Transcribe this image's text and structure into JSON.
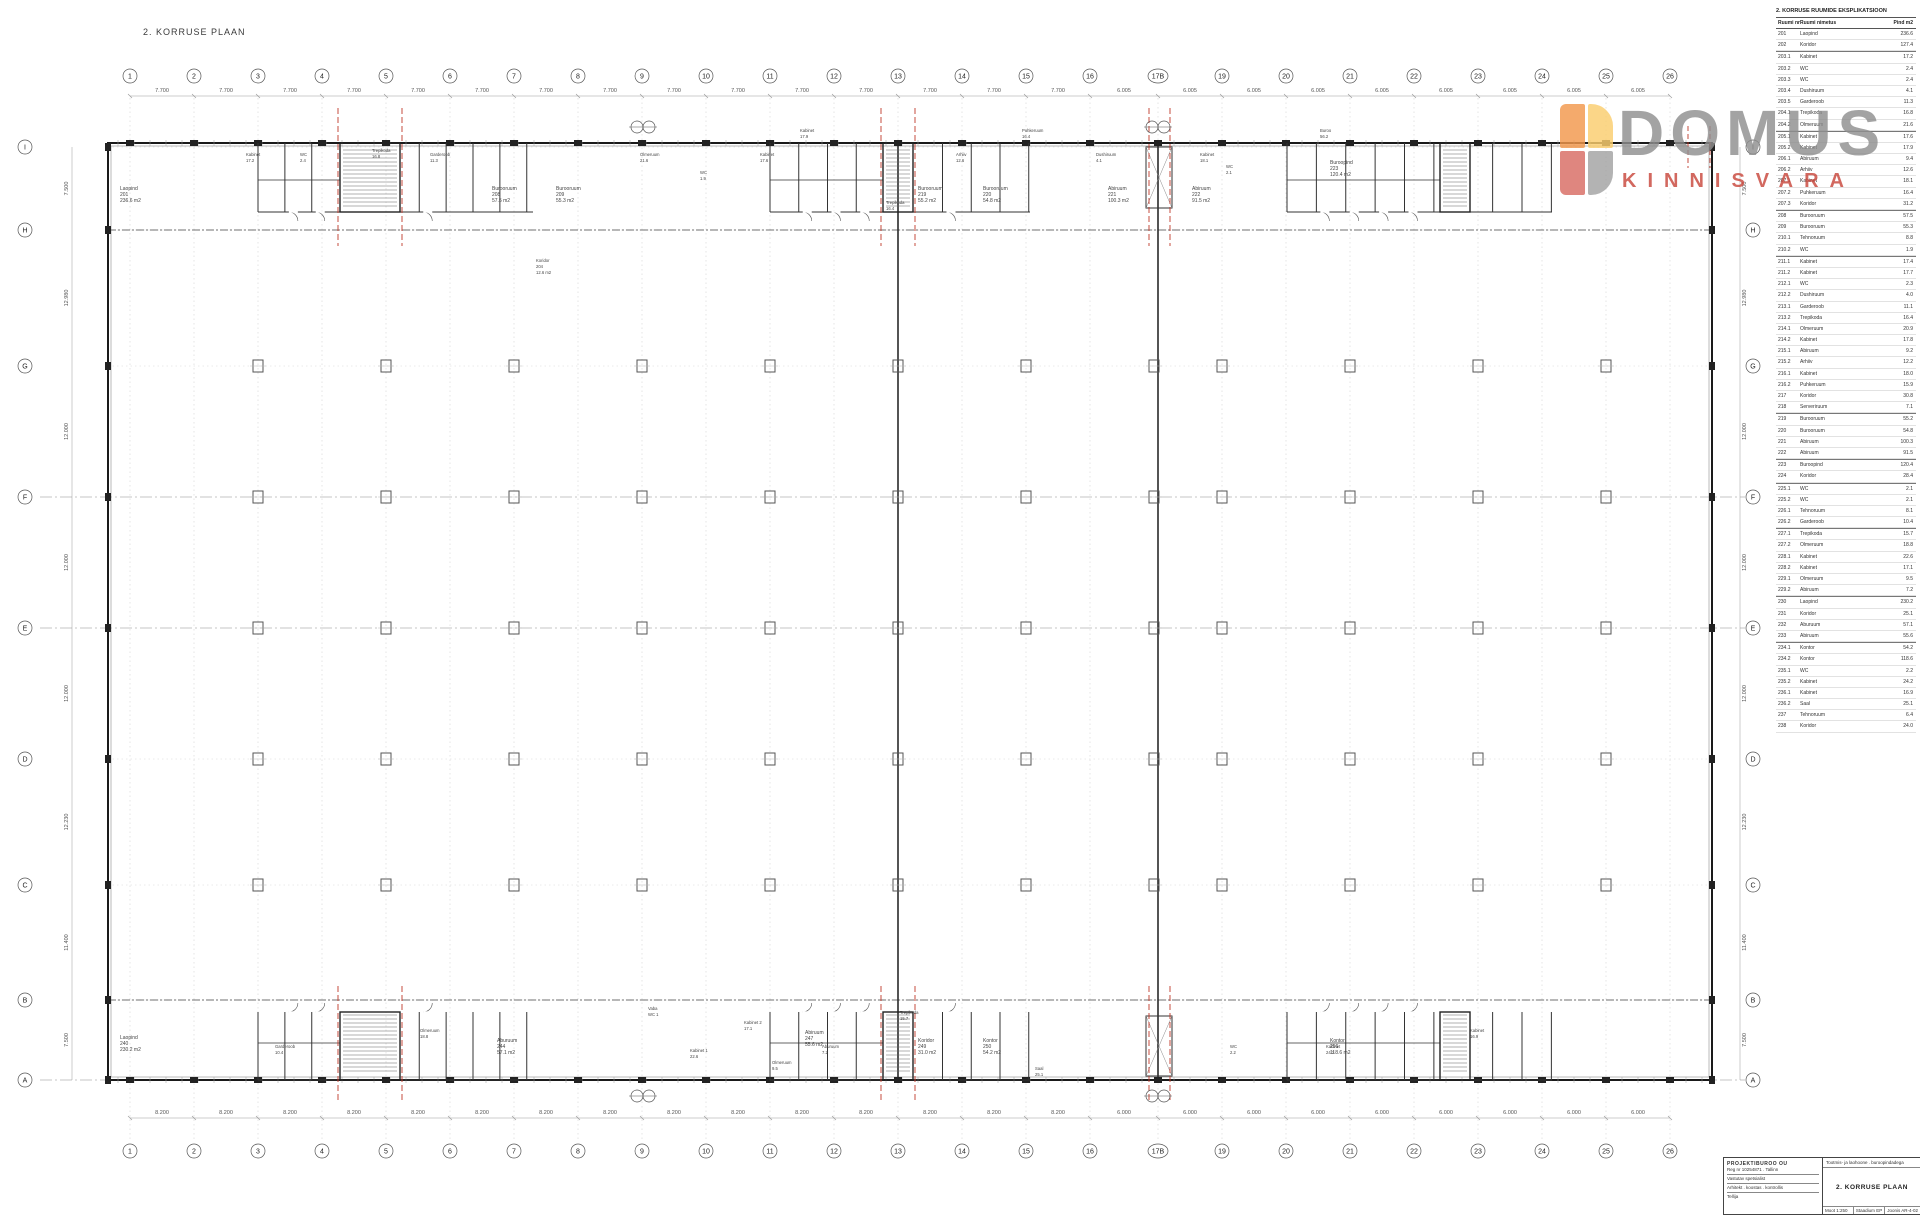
{
  "page_title": "2. KORRUSE PLAAN",
  "logo": {
    "word": "DOMUS",
    "sub": "KINNISVARA",
    "colors": {
      "tl": "#f2984d",
      "tr": "#fbce6e",
      "bl": "#d96c63",
      "br": "#a3a3a3",
      "word": "#8f8f8f",
      "sub": "#c9473c"
    }
  },
  "accent_red": "#c0392b",
  "grid": {
    "cols": [
      "1",
      "2",
      "3",
      "4",
      "5",
      "6",
      "7",
      "8",
      "9",
      "10",
      "11",
      "12",
      "13",
      "14",
      "15",
      "16",
      "17B",
      "19",
      "20",
      "21",
      "22",
      "23",
      "24",
      "25",
      "26"
    ],
    "rows": [
      "I",
      "H",
      "G",
      "F",
      "E",
      "D",
      "C",
      "B",
      "A"
    ]
  },
  "dims": {
    "top_left_bay": "7.700",
    "top_right_bay": "6.005",
    "bottom_left_bay": "8.200",
    "bottom_right_bay": "6.000",
    "left": [
      "7.500",
      "12.980",
      "12.000",
      "12.000",
      "12.000",
      "12.230",
      "11.400",
      "7.500"
    ],
    "right": [
      "7.500",
      "12.980",
      "12.000",
      "12.000",
      "12.000",
      "12.230",
      "11.400",
      "7.500"
    ]
  },
  "room_labels": [
    {
      "x": 120,
      "y": 186,
      "name": "Laopind",
      "nr": "201",
      "area": "236.6 m2"
    },
    {
      "x": 492,
      "y": 186,
      "name": "Burooruum",
      "nr": "208",
      "area": "57.5 m2"
    },
    {
      "x": 556,
      "y": 186,
      "name": "Burooruum",
      "nr": "209",
      "area": "55.3 m2"
    },
    {
      "x": 918,
      "y": 186,
      "name": "Burooruum",
      "nr": "219",
      "area": "55.2 m2"
    },
    {
      "x": 983,
      "y": 186,
      "name": "Burooruum",
      "nr": "220",
      "area": "54.8 m2"
    },
    {
      "x": 1108,
      "y": 186,
      "name": "Abiruum",
      "nr": "221",
      "area": "100.3 m2"
    },
    {
      "x": 1192,
      "y": 186,
      "name": "Abiruum",
      "nr": "222",
      "area": "91.5 m2"
    },
    {
      "x": 1330,
      "y": 160,
      "name": "Buroopind",
      "nr": "223",
      "area": "120.4 m2"
    },
    {
      "x": 120,
      "y": 1035,
      "name": "Laopind",
      "nr": "240",
      "area": "230.2 m2"
    },
    {
      "x": 497,
      "y": 1038,
      "name": "Aburuum",
      "nr": "244",
      "area": "57.1 m2"
    },
    {
      "x": 805,
      "y": 1030,
      "name": "Abiruum",
      "nr": "247",
      "area": "55.6 m2"
    },
    {
      "x": 918,
      "y": 1038,
      "name": "Koridor",
      "nr": "249",
      "area": "31.0 m2"
    },
    {
      "x": 983,
      "y": 1038,
      "name": "Kontor",
      "nr": "250",
      "area": "54.2 m2"
    },
    {
      "x": 1330,
      "y": 1038,
      "name": "Kontor",
      "nr": "256",
      "area": "118.6 m2"
    }
  ],
  "cluster_labels": [
    {
      "x": 246,
      "y": 152,
      "t": "Kabinet"
    },
    {
      "x": 246,
      "y": 158,
      "t": "17.2"
    },
    {
      "x": 300,
      "y": 152,
      "t": "WC"
    },
    {
      "x": 300,
      "y": 158,
      "t": "2.4"
    },
    {
      "x": 372,
      "y": 148,
      "t": "Trepikoda"
    },
    {
      "x": 372,
      "y": 154,
      "t": "16.8"
    },
    {
      "x": 430,
      "y": 152,
      "t": "Garderoob"
    },
    {
      "x": 430,
      "y": 158,
      "t": "11.3"
    },
    {
      "x": 536,
      "y": 258,
      "t": "Koridor"
    },
    {
      "x": 536,
      "y": 264,
      "t": "204"
    },
    {
      "x": 536,
      "y": 270,
      "t": "12.6 m2"
    },
    {
      "x": 640,
      "y": 152,
      "t": "Olmeruum"
    },
    {
      "x": 640,
      "y": 158,
      "t": "21.6"
    },
    {
      "x": 700,
      "y": 170,
      "t": "WC"
    },
    {
      "x": 700,
      "y": 176,
      "t": "1.9"
    },
    {
      "x": 760,
      "y": 152,
      "t": "Kabinet"
    },
    {
      "x": 760,
      "y": 158,
      "t": "17.6"
    },
    {
      "x": 800,
      "y": 128,
      "t": "Kabinet"
    },
    {
      "x": 800,
      "y": 134,
      "t": "17.9"
    },
    {
      "x": 886,
      "y": 200,
      "t": "Trepikoda"
    },
    {
      "x": 886,
      "y": 206,
      "t": "16.4"
    },
    {
      "x": 956,
      "y": 152,
      "t": "Arhiiv"
    },
    {
      "x": 956,
      "y": 158,
      "t": "12.6"
    },
    {
      "x": 1022,
      "y": 128,
      "t": "Puhkeruum"
    },
    {
      "x": 1022,
      "y": 134,
      "t": "16.4"
    },
    {
      "x": 1096,
      "y": 152,
      "t": "Dushiruum"
    },
    {
      "x": 1096,
      "y": 158,
      "t": "4.1"
    },
    {
      "x": 1200,
      "y": 152,
      "t": "Kabinet"
    },
    {
      "x": 1200,
      "y": 158,
      "t": "18.1"
    },
    {
      "x": 1320,
      "y": 128,
      "t": "Buroo"
    },
    {
      "x": 1320,
      "y": 134,
      "t": "56.2"
    },
    {
      "x": 1226,
      "y": 164,
      "t": "WC"
    },
    {
      "x": 1226,
      "y": 170,
      "t": "2.1"
    },
    {
      "x": 648,
      "y": 1006,
      "t": "Vaba"
    },
    {
      "x": 648,
      "y": 1012,
      "t": "WC 1"
    },
    {
      "x": 690,
      "y": 1048,
      "t": "Kabinet 1"
    },
    {
      "x": 690,
      "y": 1054,
      "t": "22.6"
    },
    {
      "x": 744,
      "y": 1020,
      "t": "Kabinet 2"
    },
    {
      "x": 744,
      "y": 1026,
      "t": "17.1"
    },
    {
      "x": 772,
      "y": 1060,
      "t": "Olmeruum"
    },
    {
      "x": 772,
      "y": 1066,
      "t": "9.5"
    },
    {
      "x": 822,
      "y": 1044,
      "t": "Aburuum"
    },
    {
      "x": 822,
      "y": 1050,
      "t": "7.2"
    },
    {
      "x": 900,
      "y": 1010,
      "t": "Trepikoda"
    },
    {
      "x": 900,
      "y": 1016,
      "t": "15.7"
    },
    {
      "x": 1035,
      "y": 1066,
      "t": "Saal"
    },
    {
      "x": 1035,
      "y": 1072,
      "t": "25.1"
    },
    {
      "x": 1326,
      "y": 1044,
      "t": "Kabinet"
    },
    {
      "x": 1326,
      "y": 1050,
      "t": "24.2"
    },
    {
      "x": 275,
      "y": 1044,
      "t": "Garderoob"
    },
    {
      "x": 275,
      "y": 1050,
      "t": "10.4"
    },
    {
      "x": 420,
      "y": 1028,
      "t": "Olmeruum"
    },
    {
      "x": 420,
      "y": 1034,
      "t": "18.8"
    },
    {
      "x": 1230,
      "y": 1044,
      "t": "WC"
    },
    {
      "x": 1230,
      "y": 1050,
      "t": "2.2"
    },
    {
      "x": 1470,
      "y": 1028,
      "t": "Kabinet"
    },
    {
      "x": 1470,
      "y": 1034,
      "t": "16.9"
    }
  ],
  "schedule": {
    "title": "2. KORRUSE RUUMIDE EKSPLIKATSIOON",
    "headers": {
      "nr": "Ruumi nr",
      "name": "Ruumi nimetus",
      "area": "Pind m2"
    },
    "rows": [
      {
        "nr": "201",
        "name": "Laopind",
        "area": "236.6",
        "sep": false
      },
      {
        "nr": "202",
        "name": "Koridor",
        "area": "127.4",
        "sep": false
      },
      {
        "nr": "203.1",
        "name": "Kabinet",
        "area": "17.2",
        "sep": true
      },
      {
        "nr": "203.2",
        "name": "WC",
        "area": "2.4",
        "sep": false
      },
      {
        "nr": "203.3",
        "name": "WC",
        "area": "2.4",
        "sep": false
      },
      {
        "nr": "203.4",
        "name": "Dushiruum",
        "area": "4.1",
        "sep": false
      },
      {
        "nr": "203.5",
        "name": "Garderoob",
        "area": "11.3",
        "sep": false
      },
      {
        "nr": "204.1",
        "name": "Trepikoda",
        "area": "16.8",
        "sep": false
      },
      {
        "nr": "204.2",
        "name": "Olmeruum",
        "area": "21.6",
        "sep": false
      },
      {
        "nr": "205.1",
        "name": "Kabinet",
        "area": "17.6",
        "sep": true
      },
      {
        "nr": "205.2",
        "name": "Kabinet",
        "area": "17.9",
        "sep": false
      },
      {
        "nr": "206.1",
        "name": "Abiruum",
        "area": "9.4",
        "sep": false
      },
      {
        "nr": "206.2",
        "name": "Arhiiv",
        "area": "12.6",
        "sep": false
      },
      {
        "nr": "207.1",
        "name": "Kabinet",
        "area": "18.1",
        "sep": false
      },
      {
        "nr": "207.2",
        "name": "Puhkeruum",
        "area": "16.4",
        "sep": false
      },
      {
        "nr": "207.3",
        "name": "Koridor",
        "area": "31.2",
        "sep": false
      },
      {
        "nr": "208",
        "name": "Burooruum",
        "area": "57.5",
        "sep": true
      },
      {
        "nr": "209",
        "name": "Burooruum",
        "area": "55.3",
        "sep": false
      },
      {
        "nr": "210.1",
        "name": "Tehnoruum",
        "area": "8.8",
        "sep": false
      },
      {
        "nr": "210.2",
        "name": "WC",
        "area": "1.9",
        "sep": false
      },
      {
        "nr": "211.1",
        "name": "Kabinet",
        "area": "17.4",
        "sep": true
      },
      {
        "nr": "211.2",
        "name": "Kabinet",
        "area": "17.7",
        "sep": false
      },
      {
        "nr": "212.1",
        "name": "WC",
        "area": "2.3",
        "sep": false
      },
      {
        "nr": "212.2",
        "name": "Dushiruum",
        "area": "4.0",
        "sep": false
      },
      {
        "nr": "213.1",
        "name": "Garderoob",
        "area": "11.1",
        "sep": false
      },
      {
        "nr": "213.2",
        "name": "Trepikoda",
        "area": "16.4",
        "sep": false
      },
      {
        "nr": "214.1",
        "name": "Olmeruum",
        "area": "20.9",
        "sep": false
      },
      {
        "nr": "214.2",
        "name": "Kabinet",
        "area": "17.8",
        "sep": false
      },
      {
        "nr": "215.1",
        "name": "Abiruum",
        "area": "9.2",
        "sep": false
      },
      {
        "nr": "215.2",
        "name": "Arhiiv",
        "area": "12.2",
        "sep": false
      },
      {
        "nr": "216.1",
        "name": "Kabinet",
        "area": "18.0",
        "sep": false
      },
      {
        "nr": "216.2",
        "name": "Puhkeruum",
        "area": "15.9",
        "sep": false
      },
      {
        "nr": "217",
        "name": "Koridor",
        "area": "30.8",
        "sep": false
      },
      {
        "nr": "218",
        "name": "Serveriruum",
        "area": "7.1",
        "sep": false
      },
      {
        "nr": "219",
        "name": "Burooruum",
        "area": "55.2",
        "sep": true
      },
      {
        "nr": "220",
        "name": "Burooruum",
        "area": "54.8",
        "sep": false
      },
      {
        "nr": "221",
        "name": "Abiruum",
        "area": "100.3",
        "sep": false
      },
      {
        "nr": "222",
        "name": "Abiruum",
        "area": "91.5",
        "sep": false
      },
      {
        "nr": "223",
        "name": "Buroopind",
        "area": "120.4",
        "sep": true
      },
      {
        "nr": "224",
        "name": "Koridor",
        "area": "28.4",
        "sep": false
      },
      {
        "nr": "225.1",
        "name": "WC",
        "area": "2.1",
        "sep": true
      },
      {
        "nr": "225.2",
        "name": "WC",
        "area": "2.1",
        "sep": false
      },
      {
        "nr": "226.1",
        "name": "Tehnoruum",
        "area": "8.1",
        "sep": false
      },
      {
        "nr": "226.2",
        "name": "Garderoob",
        "area": "10.4",
        "sep": false
      },
      {
        "nr": "227.1",
        "name": "Trepikoda",
        "area": "15.7",
        "sep": true
      },
      {
        "nr": "227.2",
        "name": "Olmeruum",
        "area": "18.8",
        "sep": false
      },
      {
        "nr": "228.1",
        "name": "Kabinet",
        "area": "22.6",
        "sep": false
      },
      {
        "nr": "228.2",
        "name": "Kabinet",
        "area": "17.1",
        "sep": false
      },
      {
        "nr": "229.1",
        "name": "Olmeruum",
        "area": "9.5",
        "sep": false
      },
      {
        "nr": "229.2",
        "name": "Abiruum",
        "area": "7.2",
        "sep": false
      },
      {
        "nr": "230",
        "name": "Laopind",
        "area": "230.2",
        "sep": true
      },
      {
        "nr": "231",
        "name": "Koridor",
        "area": "25.1",
        "sep": false
      },
      {
        "nr": "232",
        "name": "Aburuum",
        "area": "57.1",
        "sep": false
      },
      {
        "nr": "233",
        "name": "Abiruum",
        "area": "55.6",
        "sep": false
      },
      {
        "nr": "234.1",
        "name": "Kontor",
        "area": "54.2",
        "sep": true
      },
      {
        "nr": "234.2",
        "name": "Kontor",
        "area": "118.6",
        "sep": false
      },
      {
        "nr": "235.1",
        "name": "WC",
        "area": "2.2",
        "sep": false
      },
      {
        "nr": "235.2",
        "name": "Kabinet",
        "area": "24.2",
        "sep": false
      },
      {
        "nr": "236.1",
        "name": "Kabinet",
        "area": "16.9",
        "sep": false
      },
      {
        "nr": "236.2",
        "name": "Saal",
        "area": "25.1",
        "sep": false
      },
      {
        "nr": "237",
        "name": "Tehnoruum",
        "area": "6.4",
        "sep": false
      },
      {
        "nr": "238",
        "name": "Koridor",
        "area": "24.0",
        "sep": false
      }
    ]
  },
  "title_block": {
    "company": "PROJEKTIBUROO OU",
    "company_sub": "Reg nr 10254871 . Tallinn",
    "line1": "Vastutav spetsialist",
    "line2": "Arhitekt . koostas . kontrollis",
    "line3": "Tellija",
    "project": "Tootmis- ja laohoone . buroopindadega",
    "drawing_title": "2. KORRUSE PLAAN",
    "scale_label": "Moot",
    "scale": "1:250",
    "stage_label": "Staadium",
    "stage": "EP",
    "sheet_label": "Joonis",
    "sheet": "AR-4-02"
  }
}
